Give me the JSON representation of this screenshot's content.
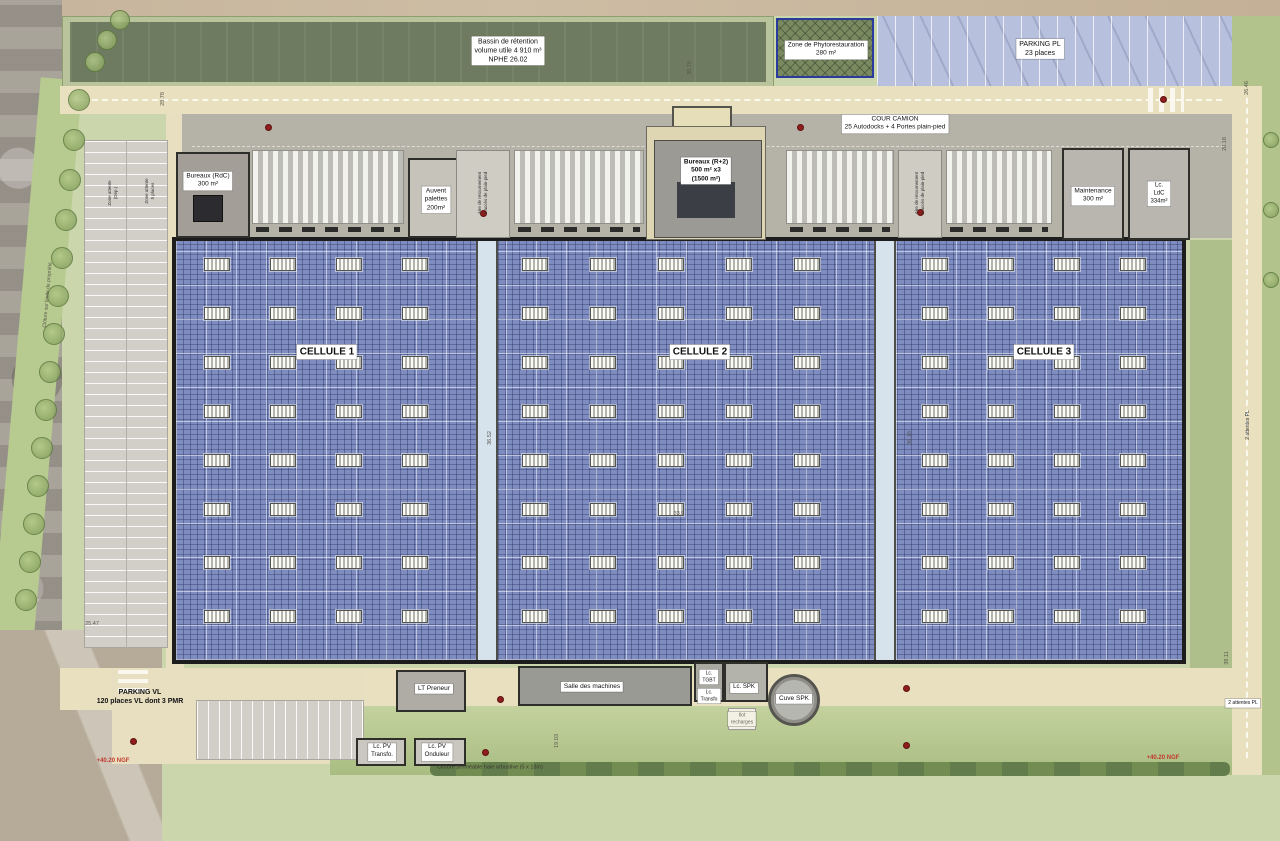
{
  "colors": {
    "pv_roof_blue": "#7f8cc0",
    "corridor_blue": "#d6e3ed",
    "site_green": "#ccd6ad",
    "basin_green": "#6f7b60",
    "parking_strip_violet": "#b7c0dc",
    "road_beige": "#e9e0bf",
    "truck_court_grey": "#b5b2a8",
    "phyto_border_blue": "#2b3a9e",
    "elevation_red": "#c23a2e"
  },
  "boxed_labels": [
    {
      "name": "bassin-retention-label",
      "text": "Bassin de rétention\nvolume utile 4 910 m³\nNPHE 26.02",
      "x": 508,
      "y": 51,
      "fs": 7
    },
    {
      "name": "zone-phyto-label",
      "text": "Zone de Phytorestauration\n280 m²",
      "x": 826,
      "y": 50,
      "fs": 6.5
    },
    {
      "name": "parking-pl-label",
      "text": "PARKING PL\n23 places",
      "x": 1040,
      "y": 49,
      "fs": 7
    },
    {
      "name": "cour-camion-label",
      "text": "COUR CAMION\n25 Autodocks + 4 Portes plain-pied",
      "x": 895,
      "y": 124,
      "fs": 6.5
    },
    {
      "name": "bureaux-rdc-label",
      "text": "Bureaux (RdC)\n300 m²",
      "x": 208,
      "y": 181,
      "fs": 6.5
    },
    {
      "name": "auvent-palettes-label",
      "text": "Auvent\npalettes\n200m²",
      "x": 436,
      "y": 200,
      "fs": 6.5
    },
    {
      "name": "bureaux-r2-label",
      "text": "Bureaux (R+2)\n500 m² x3\n(1500 m²)",
      "x": 706,
      "y": 171,
      "fs": 6.5,
      "bold": true
    },
    {
      "name": "maintenance-label",
      "text": "Maintenance\n300 m²",
      "x": 1093,
      "y": 196,
      "fs": 6.5
    },
    {
      "name": "ldc-label",
      "text": "Lc.\nLdC\n334m²",
      "x": 1159,
      "y": 194,
      "fs": 6
    },
    {
      "name": "cellule-1-label",
      "text": "CELLULE 1",
      "x": 327,
      "y": 352,
      "fs": 10,
      "bold": true
    },
    {
      "name": "cellule-2-label",
      "text": "CELLULE 2",
      "x": 700,
      "y": 352,
      "fs": 10,
      "bold": true
    },
    {
      "name": "cellule-3-label",
      "text": "CELLULE 3",
      "x": 1044,
      "y": 352,
      "fs": 10,
      "bold": true
    },
    {
      "name": "parking-vl-label",
      "text": "PARKING VL\n120 places VL dont 3 PMR",
      "x": 140,
      "y": 697,
      "fs": 7,
      "bg": "none",
      "bold": true
    },
    {
      "name": "lt-preneur-label",
      "text": "LT Preneur",
      "x": 434,
      "y": 689,
      "fs": 6.5
    },
    {
      "name": "salle-machines-label",
      "text": "Salle des machines",
      "x": 592,
      "y": 687,
      "fs": 6.5
    },
    {
      "name": "lc-tgbt-label",
      "text": "Lc.\nTGBT",
      "x": 709,
      "y": 677,
      "fs": 5
    },
    {
      "name": "lc-transfo-label",
      "text": "Lc.\nTransfo",
      "x": 709,
      "y": 696,
      "fs": 5
    },
    {
      "name": "lc-spk-label",
      "text": "Lc. SPK",
      "x": 744,
      "y": 688,
      "fs": 6
    },
    {
      "name": "cuve-spk-label",
      "text": "Cuve SPK",
      "x": 794,
      "y": 699,
      "fs": 6.5
    },
    {
      "name": "ilot-recharges-label",
      "text": "Ilot\nrecharges",
      "x": 742,
      "y": 719,
      "fs": 5,
      "bg": "cream",
      "color": "#6b695f"
    },
    {
      "name": "lc-pv-transfo-label",
      "text": "Lc. PV\nTransfo.",
      "x": 382,
      "y": 752,
      "fs": 6
    },
    {
      "name": "lc-pv-onduleur-label",
      "text": "Lc. PV\nOnduleur",
      "x": 437,
      "y": 752,
      "fs": 6
    },
    {
      "name": "cloture-permeable-label",
      "text": "Clôture perméable haie arbustive (5 x 13m)",
      "x": 490,
      "y": 768,
      "fs": 5.5,
      "bg": "none",
      "color": "#3a3a30"
    },
    {
      "name": "ngf-left-label",
      "text": "+40.20 NGF",
      "x": 113,
      "y": 762,
      "fs": 6,
      "bg": "none",
      "bold": true,
      "color": "#c23a2e"
    },
    {
      "name": "ngf-right-label",
      "text": "+40.20 NGF",
      "x": 1163,
      "y": 759,
      "fs": 6,
      "bg": "none",
      "bold": true,
      "color": "#c23a2e"
    },
    {
      "name": "aire-retournement-left-label",
      "text": "Aire de retournement\n2 accès de plain-pied",
      "x": 483,
      "y": 193,
      "fs": 4.5,
      "bg": "none",
      "rot": -90,
      "color": "#333"
    },
    {
      "name": "aire-retournement-right-label",
      "text": "Aire de retournement\n2 accès de plain-pied",
      "x": 920,
      "y": 193,
      "fs": 4.5,
      "bg": "none",
      "rot": -90,
      "color": "#333"
    },
    {
      "name": "zone-attente-dep-label",
      "text": "Zone attente\n(Dép.)",
      "x": 113,
      "y": 193,
      "fs": 4.5,
      "bg": "none",
      "rot": -90,
      "color": "#333"
    },
    {
      "name": "zone-attente-places-label",
      "text": "Zone attente\n5 places",
      "x": 150,
      "y": 191,
      "fs": 4.5,
      "bg": "none",
      "rot": -90,
      "color": "#333"
    },
    {
      "name": "cloture-limite-label",
      "text": "Clôture sur limite de propriété",
      "x": 48,
      "y": 295,
      "fs": 5,
      "bg": "none",
      "rot": -85,
      "color": "#55534a"
    },
    {
      "name": "attentes-pl-1-label",
      "text": "2 attentes PL",
      "x": 1248,
      "y": 425,
      "fs": 5,
      "bg": "none",
      "rot": -90,
      "color": "#333"
    },
    {
      "name": "attentes-pl-2-label",
      "text": "2 attentes PL",
      "x": 1243,
      "y": 703,
      "fs": 5
    }
  ],
  "dim_labels": [
    [
      "38.70",
      690,
      68,
      -90
    ],
    [
      "26.46",
      1247,
      88,
      -90
    ],
    [
      "20.18",
      1225,
      144,
      -90
    ],
    [
      "36.52",
      490,
      438,
      -90
    ],
    [
      "36.18",
      910,
      438,
      -90
    ],
    [
      "33.9",
      679,
      514,
      0
    ],
    [
      "25.47",
      92,
      624,
      0
    ],
    [
      "39.11",
      1227,
      658,
      -90
    ],
    [
      "19.03",
      557,
      741,
      -90
    ],
    [
      "28.78",
      163,
      99,
      -90
    ]
  ],
  "layout": {
    "dock_groups": [
      [
        252,
        152
      ],
      [
        514,
        130
      ],
      [
        786,
        108
      ],
      [
        946,
        106
      ]
    ],
    "skylight_rows": [
      258,
      307,
      356,
      405,
      454,
      503,
      556,
      610
    ],
    "skylight_cols": [
      [
        204,
        270,
        336,
        402
      ],
      [
        522,
        590,
        658,
        726,
        794
      ],
      [
        922,
        988,
        1054,
        1120
      ]
    ],
    "red_dots": [
      [
        268,
        127
      ],
      [
        800,
        127
      ],
      [
        1163,
        99
      ],
      [
        483,
        213
      ],
      [
        920,
        212
      ],
      [
        500,
        699
      ],
      [
        906,
        688
      ],
      [
        906,
        745
      ],
      [
        485,
        752
      ],
      [
        133,
        741
      ]
    ],
    "trees": [
      [
        79,
        100,
        11
      ],
      [
        74,
        140,
        11
      ],
      [
        70,
        180,
        11
      ],
      [
        66,
        220,
        11
      ],
      [
        62,
        258,
        11
      ],
      [
        58,
        296,
        11
      ],
      [
        54,
        334,
        11
      ],
      [
        50,
        372,
        11
      ],
      [
        46,
        410,
        11
      ],
      [
        42,
        448,
        11
      ],
      [
        38,
        486,
        11
      ],
      [
        34,
        524,
        11
      ],
      [
        30,
        562,
        11
      ],
      [
        26,
        600,
        11
      ],
      [
        95,
        62,
        10
      ],
      [
        107,
        40,
        10
      ],
      [
        120,
        20,
        10
      ],
      [
        1271,
        140,
        8
      ],
      [
        1271,
        210,
        8
      ],
      [
        1271,
        280,
        8
      ]
    ]
  }
}
